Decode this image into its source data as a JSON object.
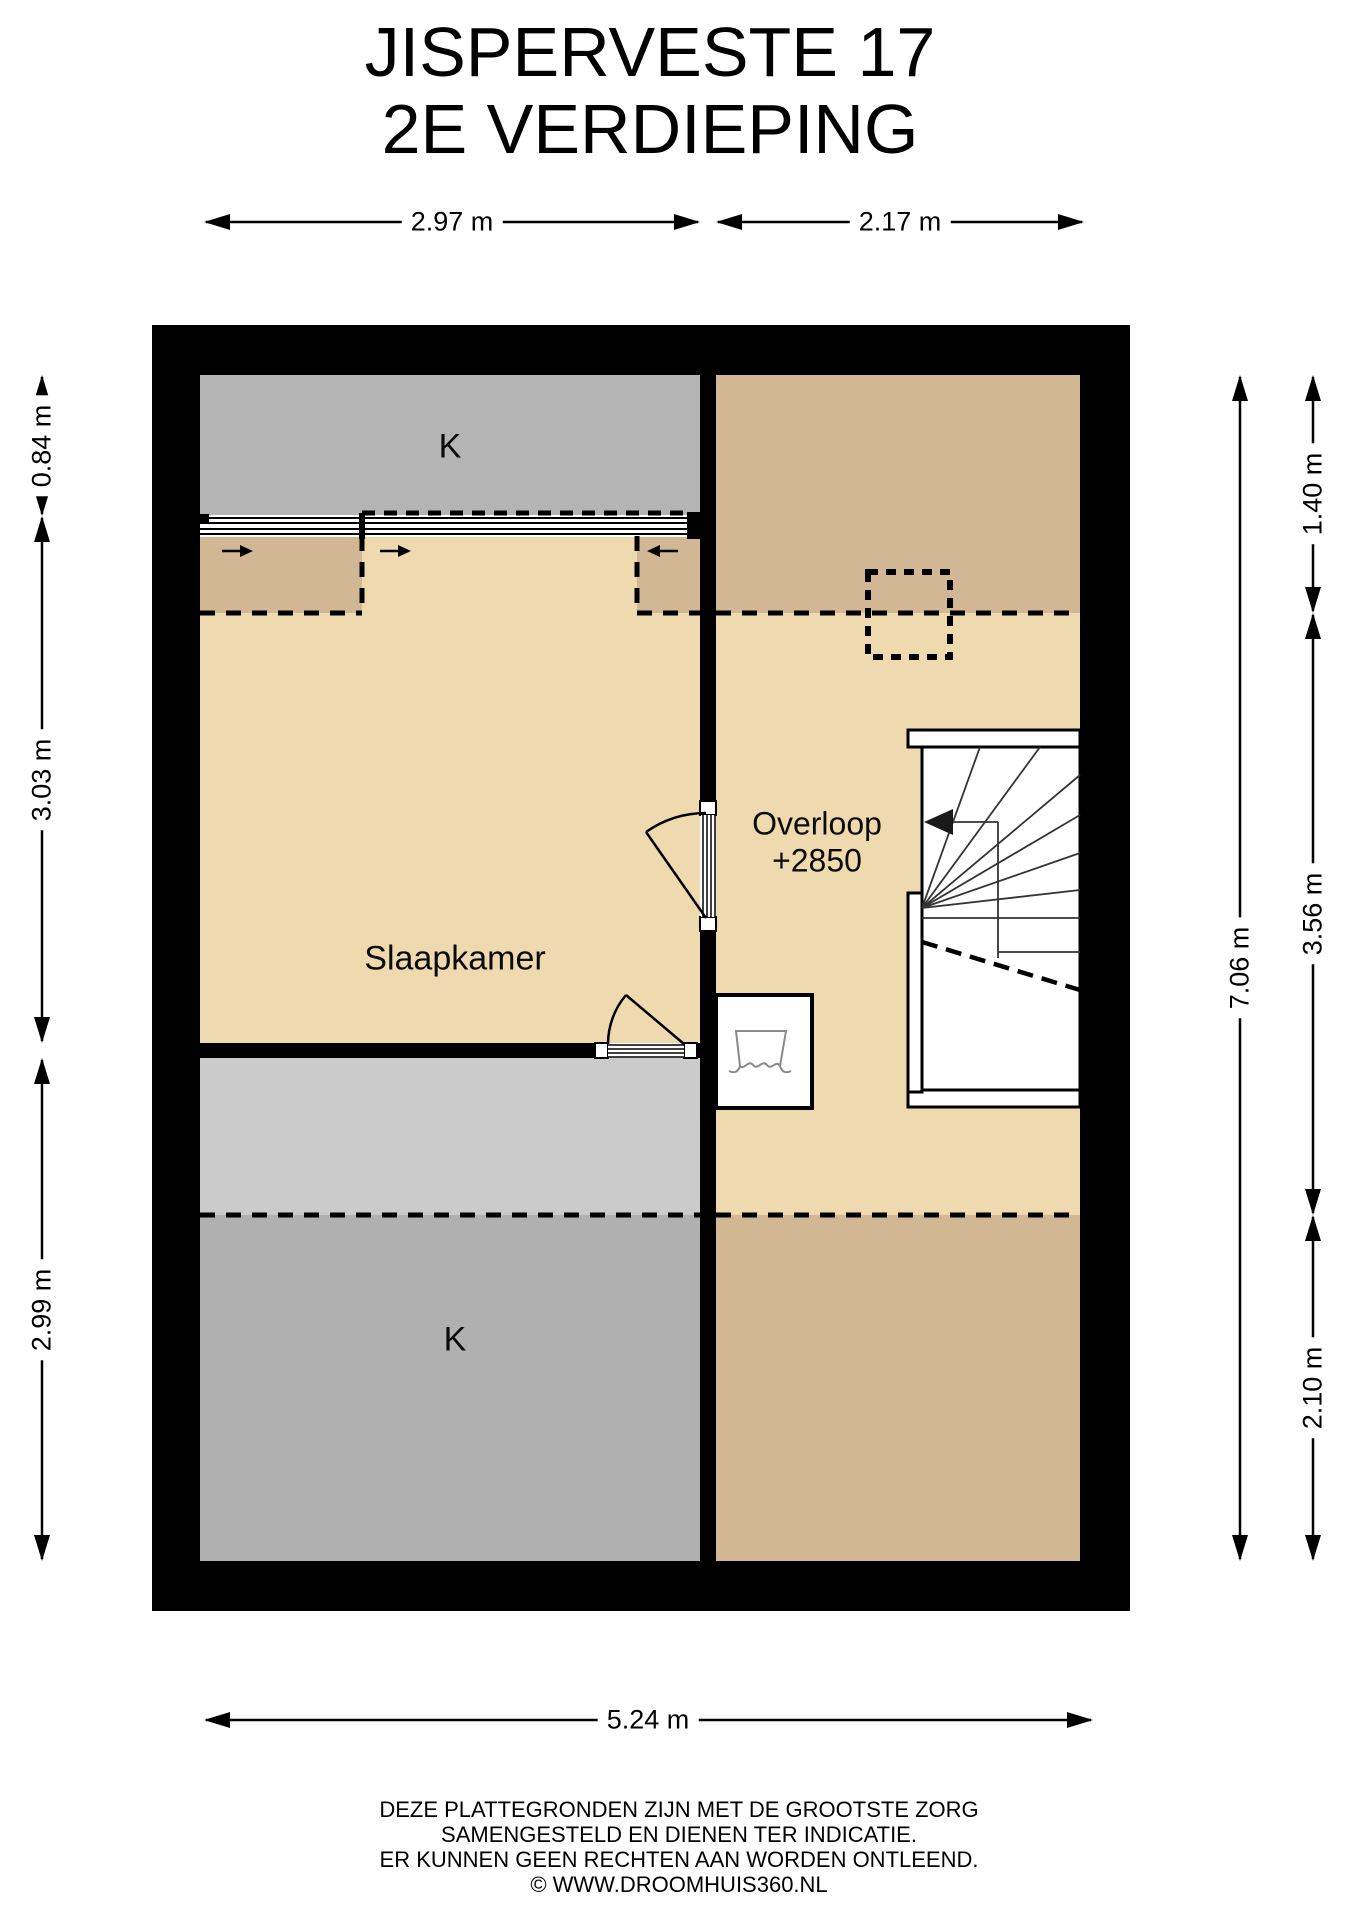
{
  "title": {
    "line1": "JISPERVESTE 17",
    "line2": "2E VERDIEPING"
  },
  "rooms": {
    "k_top": "K",
    "slaapkamer": "Slaapkamer",
    "overloop_name": "Overloop",
    "overloop_level": "+2850",
    "k_bottom": "K"
  },
  "dimensions": {
    "top_left_width": "2.97 m",
    "top_right_width": "2.17 m",
    "bottom_width": "5.24 m",
    "left_segment1": "0.84 m",
    "left_segment2": "3.03 m",
    "left_segment3": "2.99 m",
    "right_segment1": "1.40 m",
    "right_segment2": "3.56 m",
    "right_segment3": "2.10 m",
    "right_total": "7.06 m"
  },
  "footer": {
    "lines": [
      "DEZE PLATTEGRONDEN ZIJN MET DE GROOTSTE ZORG",
      "SAMENGESTELD EN DIENEN TER INDICATIE.",
      "ER KUNNEN GEEN RECHTEN AAN WORDEN ONTLEEND.",
      "© WWW.DROOMHUIS360.NL"
    ]
  },
  "colors": {
    "wall": "#000000",
    "floor_light": "#eedaae",
    "floor_low_headroom": "#d2b794",
    "storage_gray_top": "#b4b4b4",
    "storage_gray_bottom": "#b0b0b0",
    "storage_gray_light_strip": "#cbcbcb",
    "fixture_outline": "#8a8a8a"
  }
}
